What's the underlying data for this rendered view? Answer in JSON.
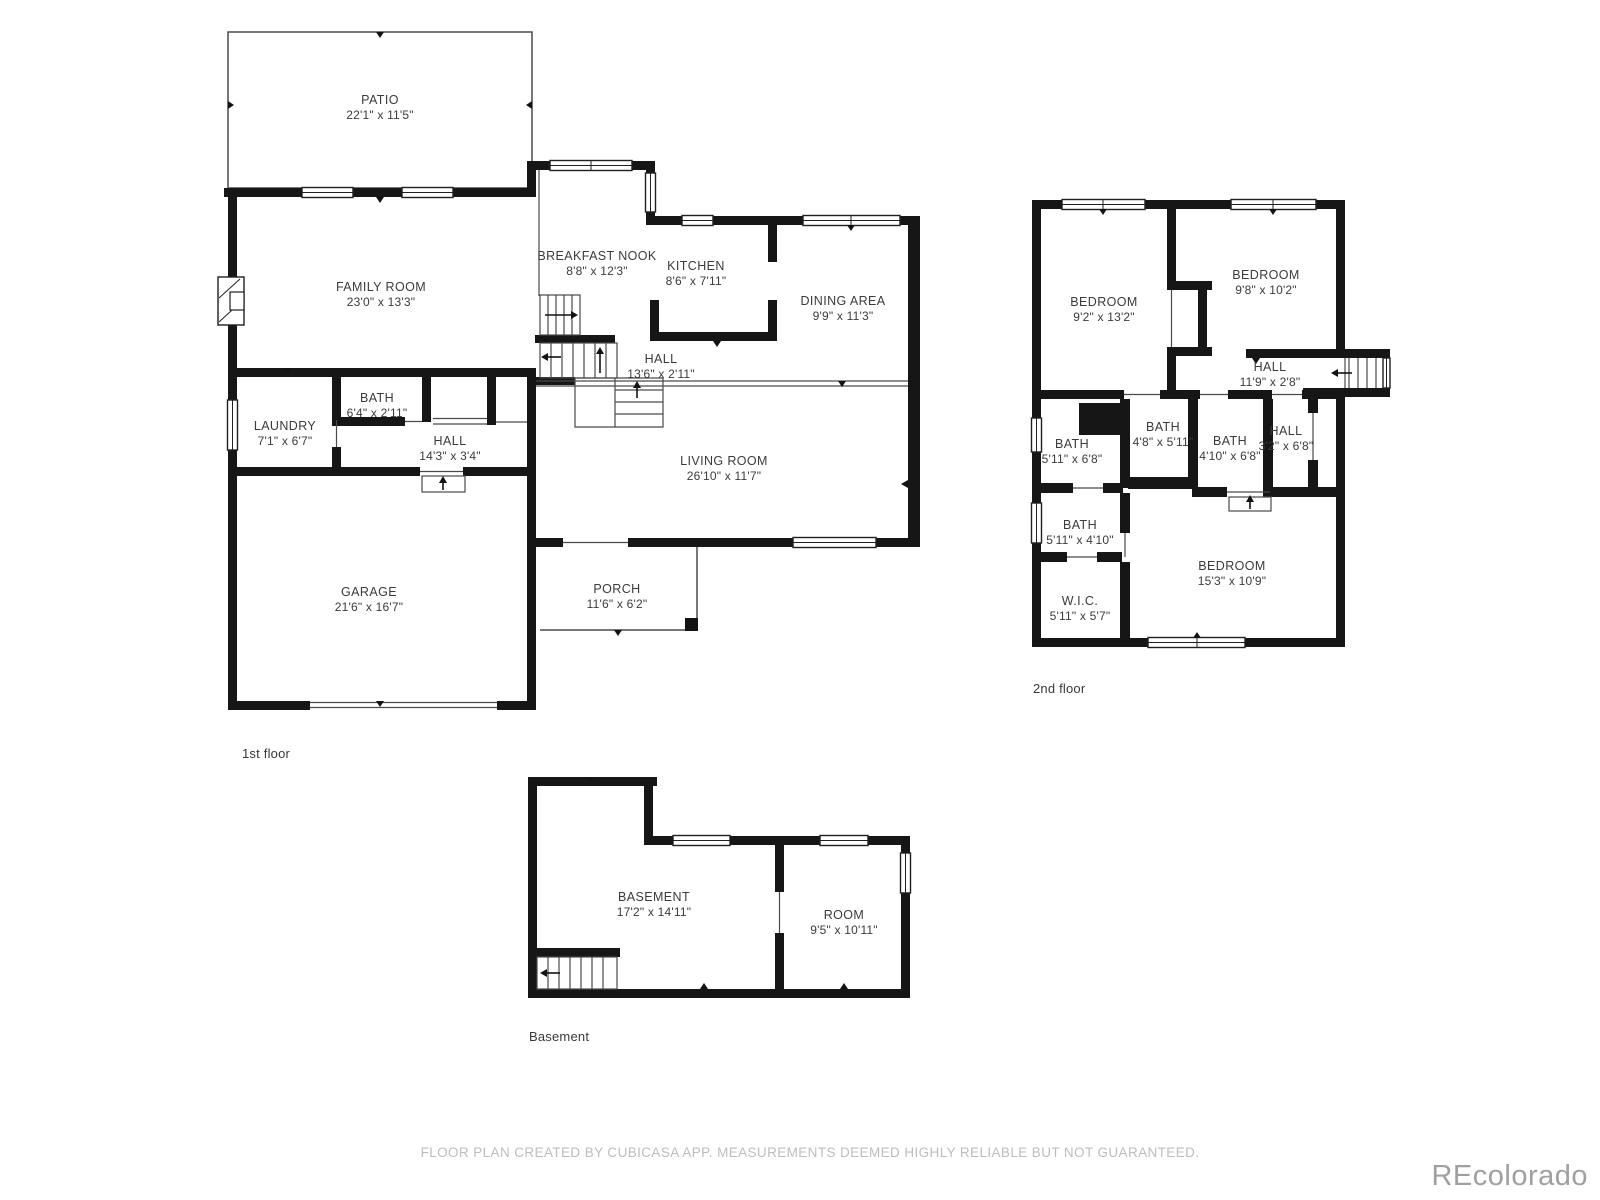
{
  "title": "Residential floor plan",
  "colors": {
    "page_bg": "#ffffff",
    "wall": "#161616",
    "thin_line": "#4a4a4a",
    "label_text": "#3b3b3b",
    "footer_text": "#bdbdbd",
    "watermark_text": "#a0a0a0"
  },
  "floors": [
    {
      "label": "1st floor",
      "rooms": [
        {
          "name": "PATIO",
          "dims": "22'1\" x 11'5\""
        },
        {
          "name": "FAMILY ROOM",
          "dims": "23'0\" x 13'3\""
        },
        {
          "name": "BREAKFAST NOOK",
          "dims": "8'8\" x 12'3\""
        },
        {
          "name": "KITCHEN",
          "dims": "8'6\" x 7'11\""
        },
        {
          "name": "DINING AREA",
          "dims": "9'9\" x 11'3\""
        },
        {
          "name": "HALL",
          "dims": "13'6\" x 2'11\""
        },
        {
          "name": "LIVING ROOM",
          "dims": "26'10\" x 11'7\""
        },
        {
          "name": "LAUNDRY",
          "dims": "7'1\" x 6'7\""
        },
        {
          "name": "BATH",
          "dims": "6'4\" x 2'11\""
        },
        {
          "name": "HALL",
          "dims": "14'3\" x 3'4\""
        },
        {
          "name": "GARAGE",
          "dims": "21'6\" x 16'7\""
        },
        {
          "name": "PORCH",
          "dims": "11'6\" x 6'2\""
        }
      ]
    },
    {
      "label": "2nd floor",
      "rooms": [
        {
          "name": "BEDROOM",
          "dims": "9'2\" x 13'2\""
        },
        {
          "name": "BEDROOM",
          "dims": "9'8\" x 10'2\""
        },
        {
          "name": "HALL",
          "dims": "11'9\" x 2'8\""
        },
        {
          "name": "BATH",
          "dims": "5'11\" x 6'8\""
        },
        {
          "name": "BATH",
          "dims": "4'8\" x 5'11\""
        },
        {
          "name": "BATH",
          "dims": "4'10\" x 6'8\""
        },
        {
          "name": "HALL",
          "dims": "3'2\" x 6'8\""
        },
        {
          "name": "BATH",
          "dims": "5'11\" x 4'10\""
        },
        {
          "name": "W.I.C.",
          "dims": "5'11\" x 5'7\""
        },
        {
          "name": "BEDROOM",
          "dims": "15'3\" x 10'9\""
        }
      ]
    },
    {
      "label": "Basement",
      "rooms": [
        {
          "name": "BASEMENT",
          "dims": "17'2\" x 14'11\""
        },
        {
          "name": "ROOM",
          "dims": "9'5\" x 10'11\""
        }
      ]
    }
  ],
  "footer": {
    "disclaimer": "FLOOR PLAN CREATED BY CUBICASA APP. MEASUREMENTS DEEMED HIGHLY RELIABLE BUT NOT GUARANTEED."
  },
  "branding": {
    "watermark": "REcolorado"
  }
}
